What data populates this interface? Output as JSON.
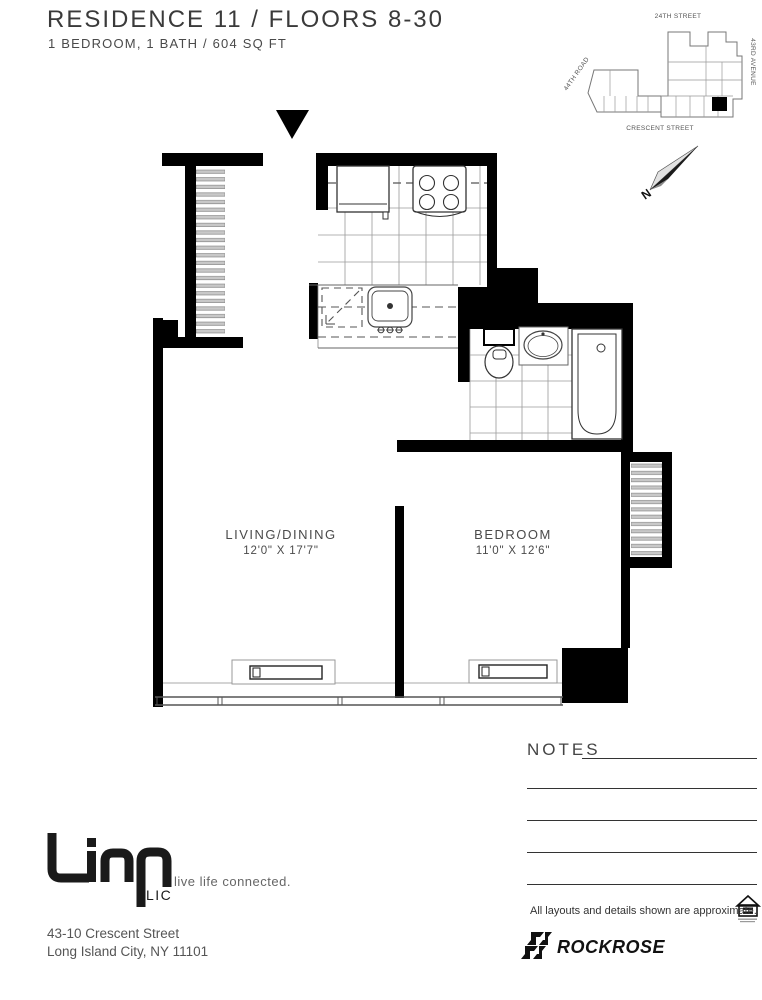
{
  "header": {
    "title": "RESIDENCE 11  /  FLOORS 8-30",
    "subtitle": "1 BEDROOM, 1 BATH  /  604 SQ FT"
  },
  "site_map": {
    "street_top": "24TH STREET",
    "street_right": "43RD AVENUE",
    "street_bottom": "CRESCENT STREET",
    "street_left": "44TH ROAD"
  },
  "compass": {
    "north_label": "N"
  },
  "rooms": {
    "living": {
      "name": "LIVING/DINING",
      "dimensions": "12'0\" X 17'7\""
    },
    "bedroom": {
      "name": "BEDROOM",
      "dimensions": "11'0\" X 12'6\""
    }
  },
  "notes": {
    "heading": "NOTES"
  },
  "footer": {
    "brand": "Linc",
    "brand_sub": "LIC",
    "tagline": "live life connected.",
    "address_line1": "43-10 Crescent Street",
    "address_line2": "Long Island City, NY 11101",
    "disclaimer": "All layouts and details shown are approximate.",
    "developer": "ROCKROSE"
  },
  "colors": {
    "wall": "#000000",
    "line_dark": "#333333",
    "line_light": "#999999",
    "slat_fill": "#c8c8c8"
  }
}
